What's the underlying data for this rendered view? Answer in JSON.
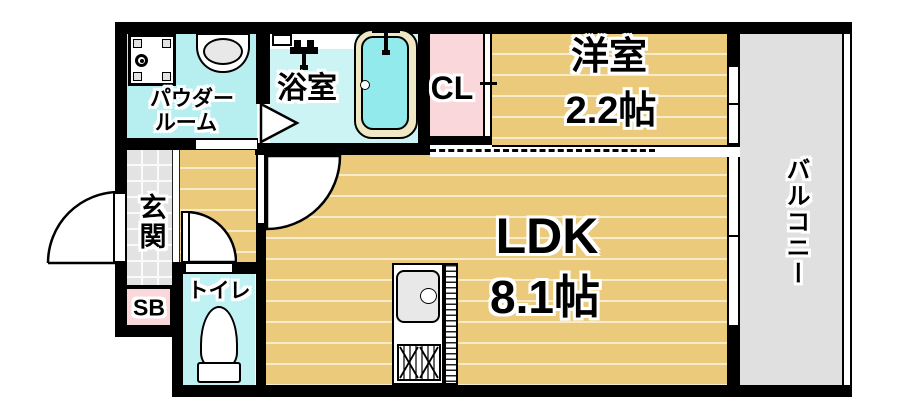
{
  "rooms": {
    "powder_room": {
      "lines": [
        "パウダー",
        "ルーム"
      ]
    },
    "bathroom": {
      "label": "浴室"
    },
    "closet": {
      "label": "CL"
    },
    "western_room": {
      "label": "洋室",
      "size": "2.2帖"
    },
    "balcony": {
      "label": "バルコニー"
    },
    "entrance": {
      "label": "玄関"
    },
    "shoe_box": {
      "label": "SB"
    },
    "toilet": {
      "label": "トイレ"
    },
    "ldk": {
      "label": "LDK",
      "size": "8.1帖"
    }
  },
  "icons": {
    "washing_machine_pan": "square pan with drain circle",
    "bathroom_sink": "oval basin on counter",
    "shower_fixture": "faucet with hanging hose",
    "bathtub": "rounded tub with rim and faucet",
    "toilet_bowl": "egg bowl with tank",
    "kitchen_sink": "rounded sink with faucet",
    "gas_stove": "grill with two crossed burners",
    "door_swing": "quarter-circle arc",
    "sliding_door": "dashed track line"
  },
  "colors": {
    "wall": "#000000",
    "wood_floor": "#ecca7c",
    "plank_line": "#f6ecca",
    "powder_cyan": "#b7eff1",
    "bath_cyan": "#cdf4f5",
    "toilet_cyan": "#c0f1f3",
    "pink": "#f9d7db",
    "tile_gray": "#e3e3e3",
    "balcony_gray": "#e0e0e0",
    "tub_fill": "#93eaec",
    "tub_rim": "#eee9c4",
    "fixture_gray": "#e8e8e8"
  }
}
